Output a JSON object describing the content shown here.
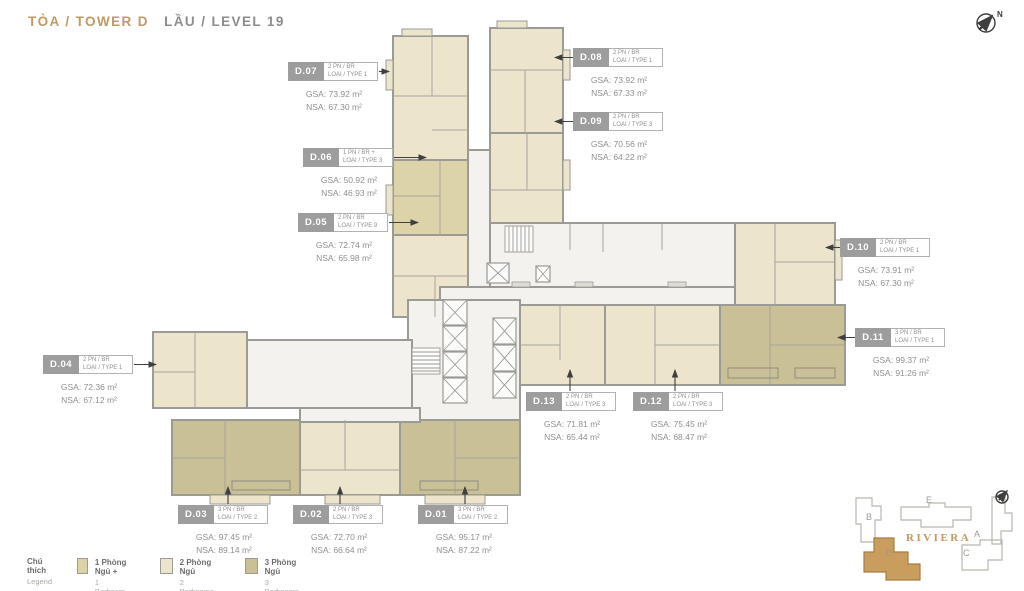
{
  "header": {
    "building": "TÒA / TOWER D",
    "level": "LẦU / LEVEL 19"
  },
  "compass": {
    "label": "N"
  },
  "units": [
    {
      "id": "D.01",
      "bed": "3 PN / BR",
      "type": "LOẠI / TYPE 2",
      "gsa": "GSA: 95.17 m²",
      "nsa": "NSA: 87.22 m²"
    },
    {
      "id": "D.02",
      "bed": "2 PN / BR",
      "type": "LOẠI / TYPE 3",
      "gsa": "GSA: 72.70 m²",
      "nsa": "NSA: 66.64 m²"
    },
    {
      "id": "D.03",
      "bed": "3 PN / BR",
      "type": "LOẠI / TYPE 2",
      "gsa": "GSA: 97.45 m²",
      "nsa": "NSA: 89.14 m²"
    },
    {
      "id": "D.04",
      "bed": "2 PN / BR",
      "type": "LOẠI / TYPE 1",
      "gsa": "GSA: 72.36 m²",
      "nsa": "NSA: 67.12 m²"
    },
    {
      "id": "D.05",
      "bed": "2 PN / BR",
      "type": "LOẠI / TYPE 9",
      "gsa": "GSA: 72.74 m²",
      "nsa": "NSA: 65.98 m²"
    },
    {
      "id": "D.06",
      "bed": "1 PN / BR +",
      "type": "LOẠI / TYPE 3",
      "gsa": "GSA: 50.92 m²",
      "nsa": "NSA: 46.93 m²"
    },
    {
      "id": "D.07",
      "bed": "2 PN / BR",
      "type": "LOẠI / TYPE 1",
      "gsa": "GSA: 73.92 m²",
      "nsa": "NSA: 67.30 m²"
    },
    {
      "id": "D.08",
      "bed": "2 PN / BR",
      "type": "LOẠI / TYPE 1",
      "gsa": "GSA: 73.92 m²",
      "nsa": "NSA: 67.33 m²"
    },
    {
      "id": "D.09",
      "bed": "2 PN / BR",
      "type": "LOẠI / TYPE 3",
      "gsa": "GSA: 70.56 m²",
      "nsa": "NSA: 64.22 m²"
    },
    {
      "id": "D.10",
      "bed": "2 PN / BR",
      "type": "LOẠI / TYPE 1",
      "gsa": "GSA: 73.91 m²",
      "nsa": "NSA: 67.30 m²"
    },
    {
      "id": "D.11",
      "bed": "3 PN / BR",
      "type": "LOẠI / TYPE 1",
      "gsa": "GSA: 99.37 m²",
      "nsa": "NSA: 91.26 m²"
    },
    {
      "id": "D.12",
      "bed": "2 PN / BR",
      "type": "LOẠI / TYPE 3",
      "gsa": "GSA: 75.45 m²",
      "nsa": "NSA: 68.47 m²"
    },
    {
      "id": "D.13",
      "bed": "2 PN / BR",
      "type": "LOẠI / TYPE 3",
      "gsa": "GSA: 71.81 m²",
      "nsa": "NSA: 65.44 m²"
    }
  ],
  "legend": {
    "title_vi": "Chú thích",
    "title_en": "Legend",
    "items": [
      {
        "vi": "1 Phòng Ngủ +",
        "en": "1 Bedroom +",
        "color": "#dcd3a9"
      },
      {
        "vi": "2 Phòng Ngủ",
        "en": "2 Bedrooms",
        "color": "#ece5cc"
      },
      {
        "vi": "3 Phòng Ngủ",
        "en": "3 Bedrooms",
        "color": "#c9c095"
      }
    ]
  },
  "site_map": {
    "project": "RIVIERA",
    "buildings": [
      "B",
      "E",
      "A",
      "C",
      "D"
    ],
    "highlighted": "D",
    "highlight_color": "#c89d5e"
  },
  "colors": {
    "accent_gold": "#bf9a63",
    "title_gray": "#8c8c8c",
    "wall_gray": "#9b9a94",
    "corridor": "#f3f2ee",
    "label_badge_bg": "#9d9d9d"
  }
}
